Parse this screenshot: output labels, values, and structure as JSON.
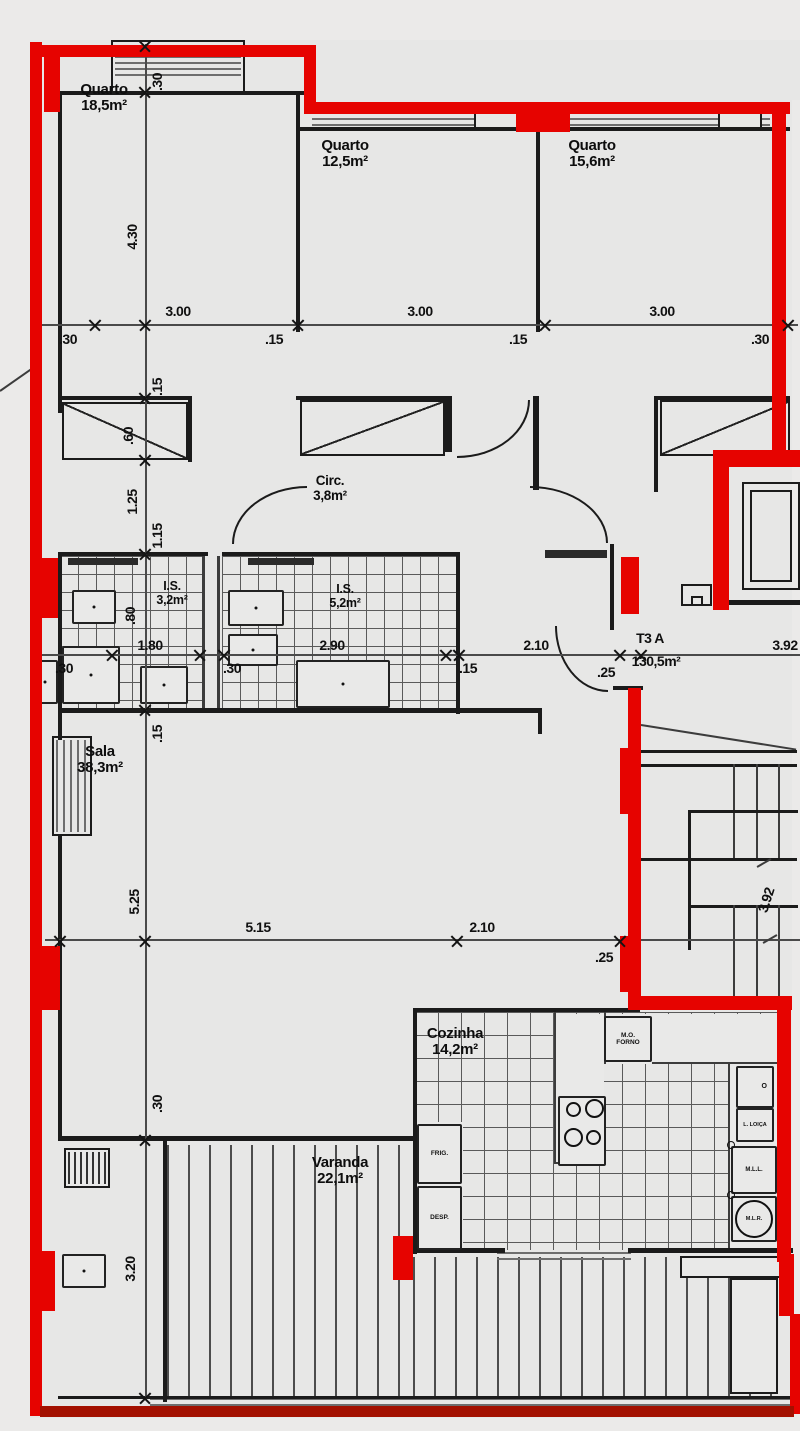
{
  "unit_label": {
    "name": "T3 A",
    "area": "130,5m²"
  },
  "rooms": {
    "quarto1": {
      "name": "Quarto",
      "area": "18,5m²"
    },
    "quarto2": {
      "name": "Quarto",
      "area": "12,5m²"
    },
    "quarto3": {
      "name": "Quarto",
      "area": "15,6m²"
    },
    "circ": {
      "name": "Circ.",
      "area": "3,8m²"
    },
    "is1": {
      "name": "I.S.",
      "area": "3,2m²"
    },
    "is2": {
      "name": "I.S.",
      "area": "5,2m²"
    },
    "sala": {
      "name": "Sala",
      "area": "38,3m²"
    },
    "cozinha": {
      "name": "Cozinha",
      "area": "14,2m²"
    },
    "varanda": {
      "name": "Varanda",
      "area": "22,1m²"
    }
  },
  "kitchen": {
    "mo_l1": "M.O.",
    "mo_l2": "FORNO",
    "frig": "FRIG.",
    "desp": "DESP.",
    "o": "O",
    "l_loica": "L. LOIÇA",
    "mll": "M.L.L.",
    "mlr": "M.L.R."
  },
  "dims": {
    "top_widths": [
      "3.00",
      "3.00",
      "3.00"
    ],
    "top_offsets": [
      ".30",
      ".15",
      ".15",
      ".30"
    ],
    "left_chain": [
      ".30",
      "4.30",
      ".15",
      ".60",
      "1.25",
      "1.15",
      ".80",
      ".15",
      "5.25",
      ".30",
      "3.20"
    ],
    "mid_row": [
      "1.80",
      "2.90",
      "2.10",
      "3.92"
    ],
    "mid_offsets": [
      ".30",
      ".30",
      ".15",
      ".25"
    ],
    "lower_row": [
      "5.15",
      "2.10"
    ],
    "lower_offsets": [
      ".25"
    ],
    "stair_dim": "3.92"
  },
  "colors": {
    "highlight_wall": "#e60300",
    "baseline_wall": "#a31000"
  }
}
